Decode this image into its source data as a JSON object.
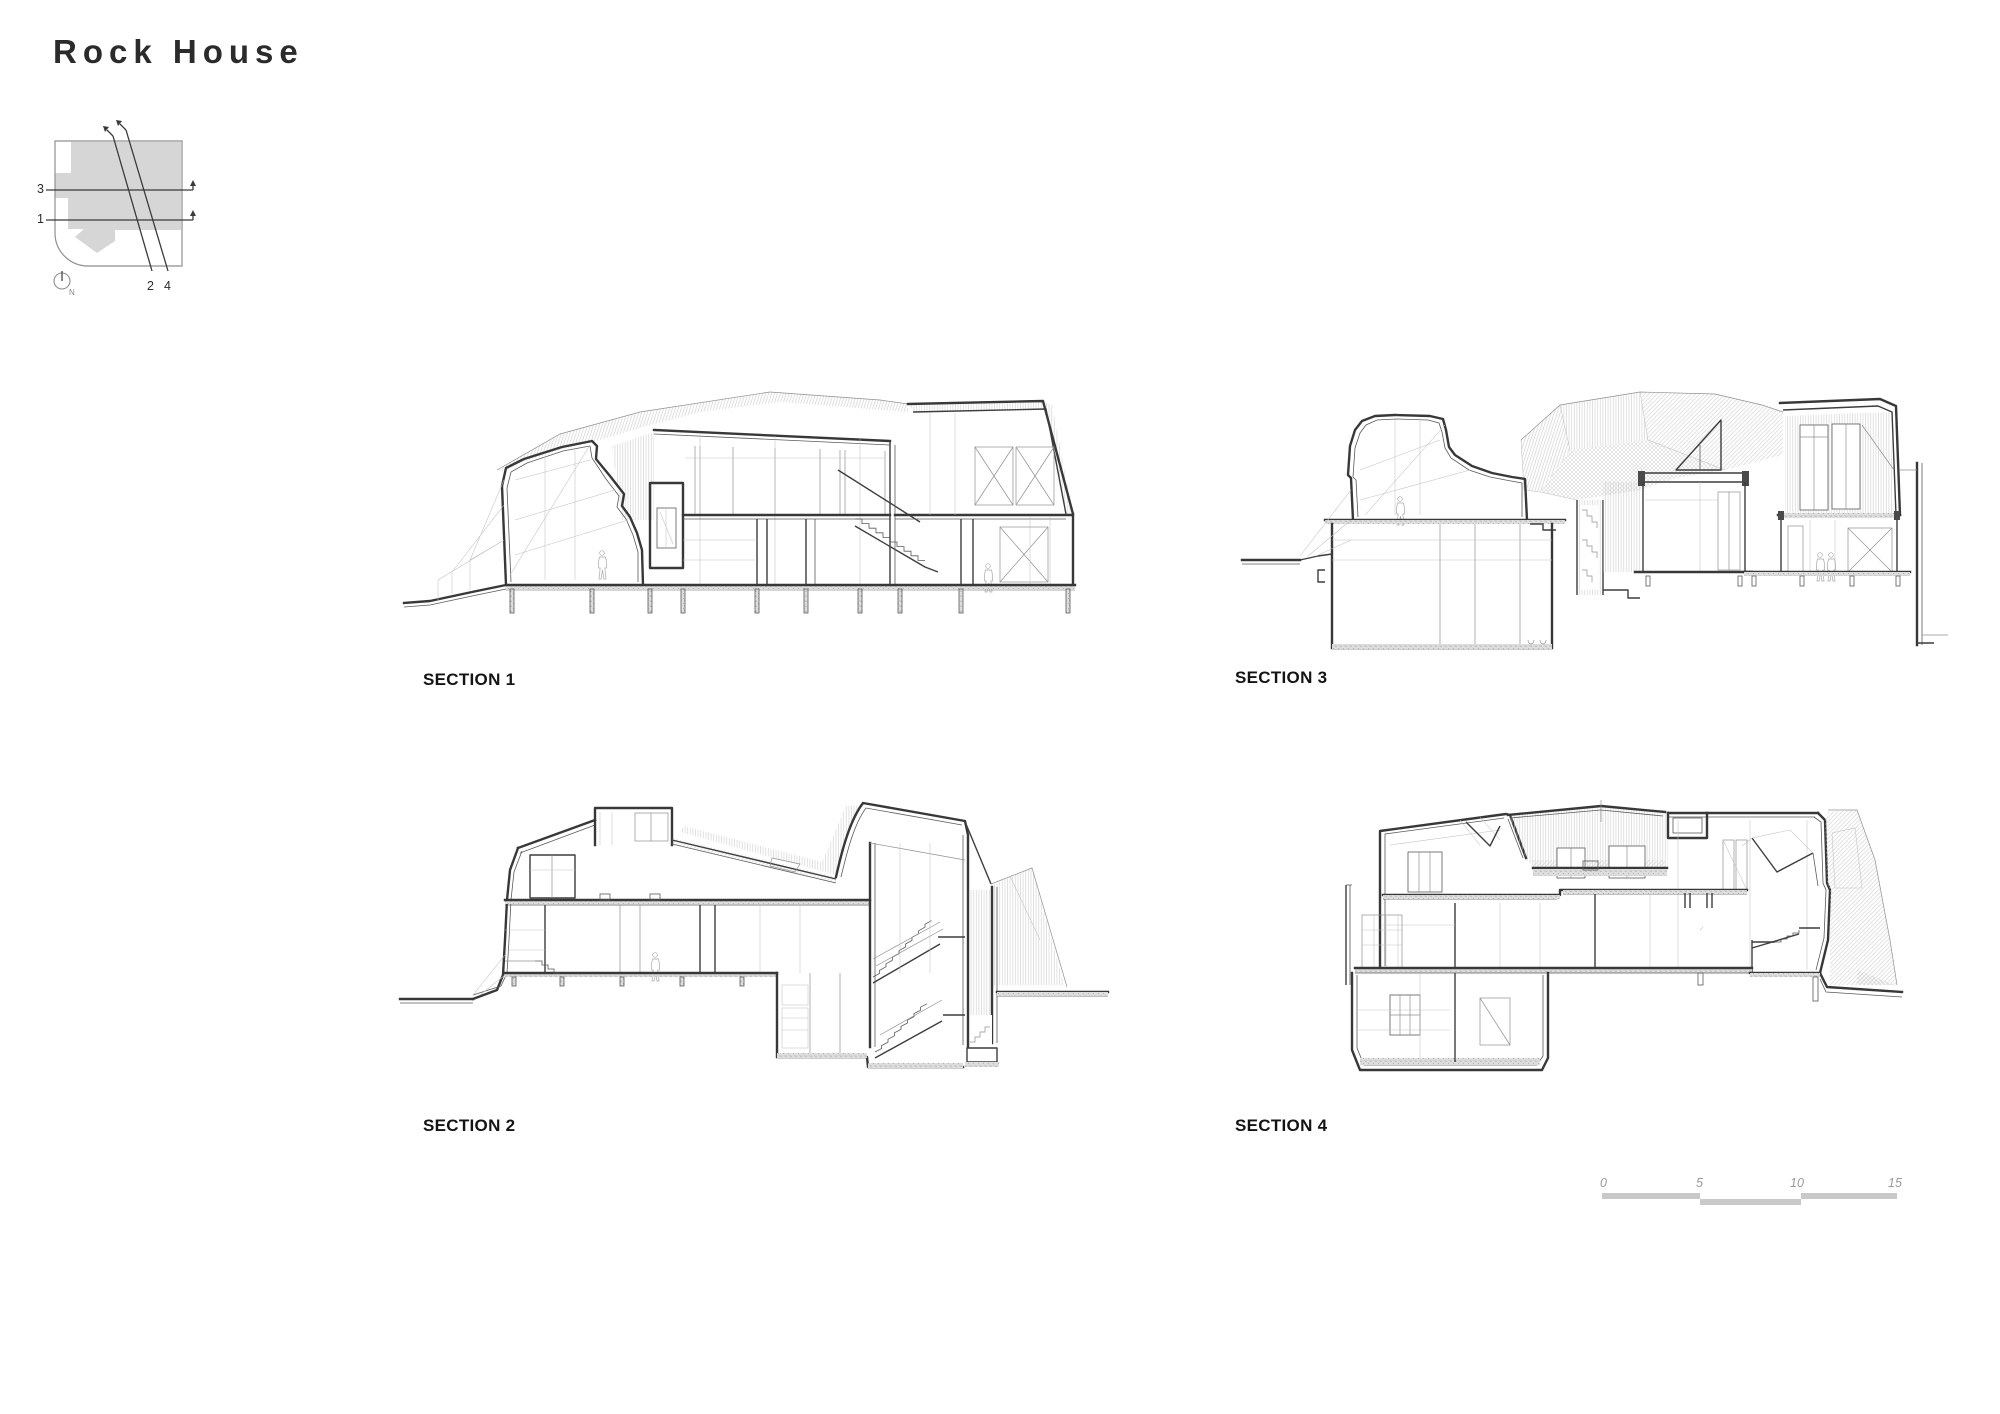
{
  "page": {
    "title": "Rock House"
  },
  "key_plan": {
    "labels": {
      "line1": "1",
      "line2": "2",
      "line3": "3",
      "line4": "4"
    },
    "north_label": "N"
  },
  "sections": {
    "s1": {
      "label": "SECTION 1"
    },
    "s2": {
      "label": "SECTION 2"
    },
    "s3": {
      "label": "SECTION 3"
    },
    "s4": {
      "label": "SECTION 4"
    }
  },
  "scale_bar": {
    "ticks": [
      "0",
      "5",
      "10",
      "15"
    ]
  },
  "colors": {
    "ink": "#2b2b2b",
    "drawing_line": "#3a3a3a",
    "light_line": "#c2c2c2",
    "plan_fill": "#d6d6d6",
    "scale_fill": "#c9c9c9",
    "muted_label": "#9a9a9a"
  }
}
